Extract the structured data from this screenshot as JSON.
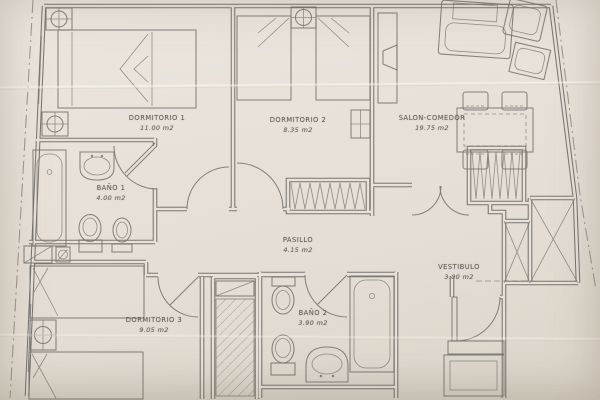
{
  "document": {
    "type": "Apartment floor plan (scanned drawing)",
    "language": "es"
  },
  "rooms": [
    {
      "id": "dormitorio-1",
      "name": "DORMITORIO 1",
      "area": "11.00 m2"
    },
    {
      "id": "dormitorio-2",
      "name": "DORMITORIO 2",
      "area": "8.35 m2"
    },
    {
      "id": "salon-comedor",
      "name": "SALON-COMEDOR",
      "area": "19.75 m2"
    },
    {
      "id": "bano-1",
      "name": "BAÑO 1",
      "area": "4.00 m2"
    },
    {
      "id": "pasillo",
      "name": "PASILLO",
      "area": "4.15 m2"
    },
    {
      "id": "vestibulo",
      "name": "VESTIBULO",
      "area": "3.00 m2"
    },
    {
      "id": "dormitorio-3",
      "name": "DORMITORIO 3",
      "area": "9.05 m2"
    },
    {
      "id": "bano-2",
      "name": "BAÑO 2",
      "area": "3.90 m2"
    }
  ],
  "fixtures": [
    "double-bed-icon",
    "single-bed-icon",
    "nightstand-icon",
    "bathtub-icon",
    "washbasin-icon",
    "toilet-icon",
    "bidet-icon",
    "sofa-icon",
    "side-table-icon",
    "tv-unit-icon",
    "dining-table-icon",
    "chair-icon",
    "wardrobe-icon",
    "closet-icon",
    "shaft-icon",
    "door-swing-icon",
    "vent-icon",
    "entrance-cabinet-icon",
    "boundary-line-icon"
  ],
  "colors": {
    "paper": "#e7e1d8",
    "wall": "#5f5d59",
    "ink": "#73716c",
    "text": "#615f5b",
    "boundary": "#8b8780"
  }
}
